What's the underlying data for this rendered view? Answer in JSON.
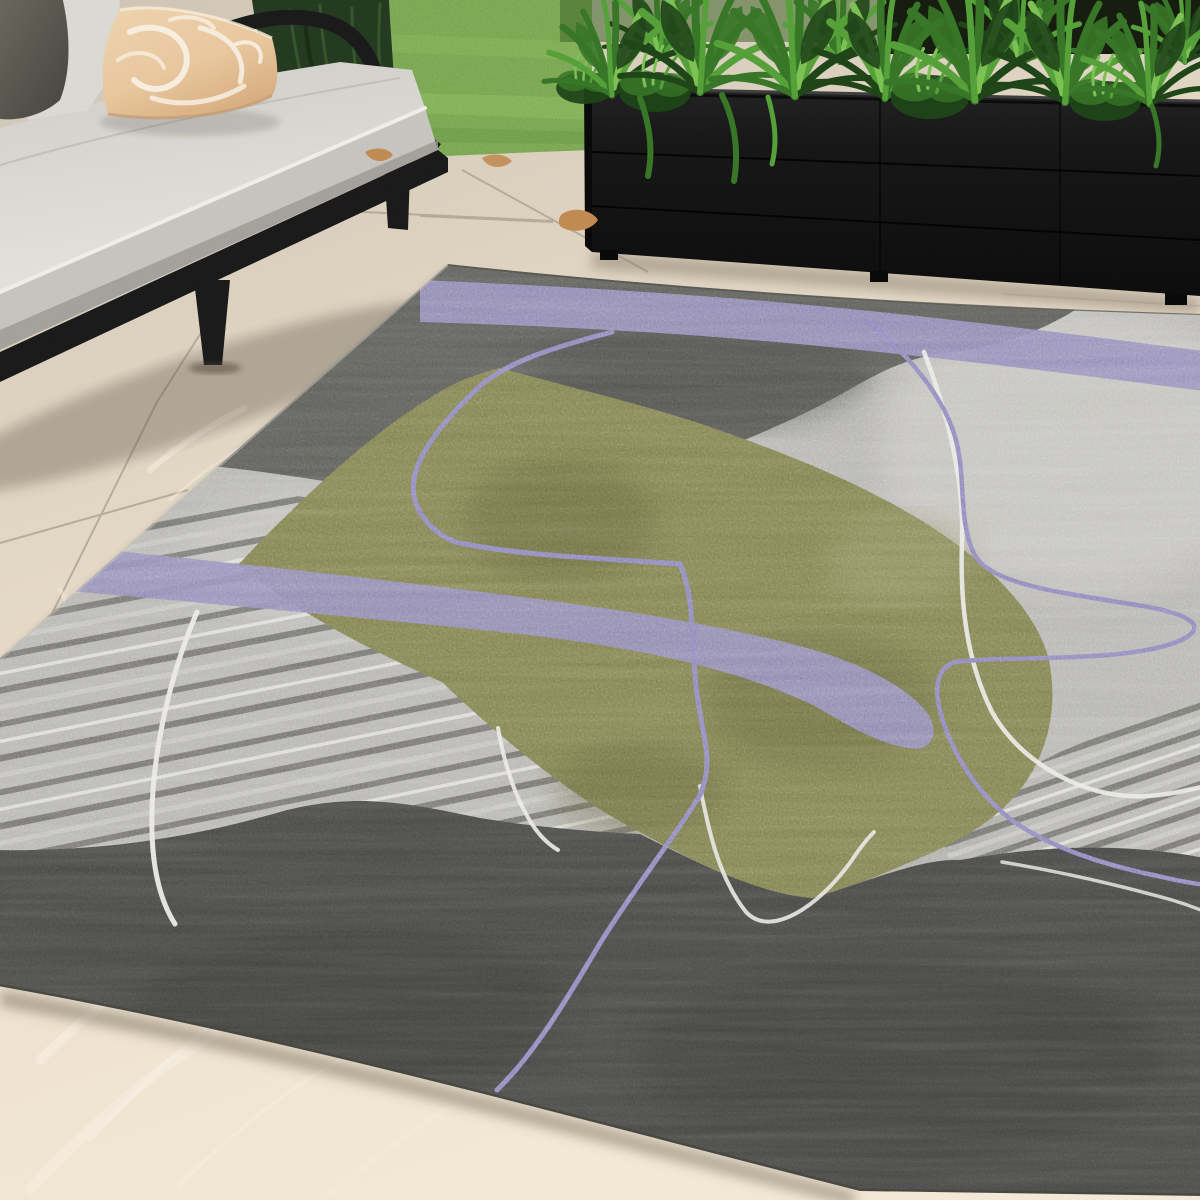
{
  "scene": {
    "setting": "outdoor patio with abstract area rug",
    "objects": [
      {
        "name": "tile-floor",
        "label": "Beige porcelain tile patio floor"
      },
      {
        "name": "lawn",
        "label": "Green lawn"
      },
      {
        "name": "weeping-tree",
        "label": "Weeping evergreen foliage"
      },
      {
        "name": "planter-box",
        "label": "Black rectangular planter"
      },
      {
        "name": "planter-plants",
        "label": "Tropical green plants"
      },
      {
        "name": "outdoor-sofa",
        "label": "Black-frame outdoor sofa with light gray cushions"
      },
      {
        "name": "dark-throw-pillow",
        "label": "Charcoal throw pillow"
      },
      {
        "name": "patterned-throw-pillow",
        "label": "Peach floral throw pillow"
      },
      {
        "name": "area-rug",
        "label": "Abstract gray, olive and lavender area rug"
      },
      {
        "name": "fallen-leaves",
        "label": "Fallen tan leaves"
      }
    ]
  },
  "palette": {
    "floor_a": "#cfc5b5",
    "floor_b": "#ded3c2",
    "floor_c": "#ecdfcc",
    "floor_d": "#f3e8d6",
    "grout": "#a99d8b",
    "vein": "#f6efe3",
    "lawn": "#76a748",
    "lawn_light": "#8dbb5f",
    "lawn_dark": "#5d8c39",
    "tree_dark": "#243a20",
    "tree_mid": "#3b5c30",
    "backdrop_dark": "#161d10",
    "backdrop_mid": "#3f6429",
    "plant_dark": "#1f4418",
    "plant_mid": "#377627",
    "plant_light": "#55a039",
    "plant_bright": "#7cc153",
    "planter": "#161616",
    "planter_side": "#0a0a0a",
    "planter_rim": "#3d3d3d",
    "planter_seam": "#040404",
    "planter_shadow": "#887c6c",
    "frame": "#1a1a1a",
    "frame_hi": "#343434",
    "cushion_top": "#dbd9d4",
    "cushion_front": "#c6c4bf",
    "cushion_dark": "#9b9993",
    "piping": "#efede8",
    "pillow_dark_a": "#625f58",
    "pillow_dark_b": "#47453f",
    "peach": "#e8c79e",
    "peach_dark": "#d9b084",
    "pattern_white": "#f8f2e7",
    "leaf_tan": "#c08a52",
    "rug_base": "#b5b4b0",
    "rug_light": "#c9c8c3",
    "rug_mid": "#a2a19d",
    "rug_dark": "#5c5c58",
    "rug_dark2": "#4c4c48",
    "rug_charcoal": "#474745",
    "rug_charcoal2": "#3a3a38",
    "rug_olive": "#7e7f51",
    "rug_olive_dark": "#62633e",
    "rug_olive_light": "#95966a",
    "rug_purple": "#918bb9",
    "rug_purple_line": "#8b84ba",
    "rug_white": "#e9e8e3",
    "stripe_dark": "#6a6a66",
    "stripe_light": "#c6c5c0",
    "stripe_white": "#e3e2dd",
    "shadow_warm": "rgba(95,82,66,0.45)"
  }
}
